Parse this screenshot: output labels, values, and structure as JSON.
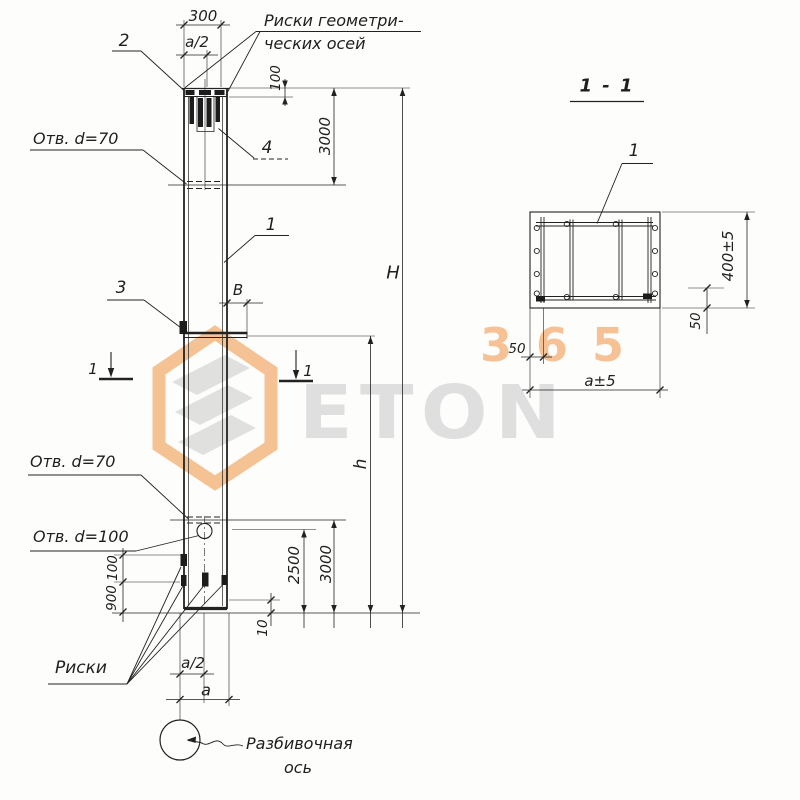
{
  "watermark": {
    "digits": "365",
    "brand": "ETON"
  },
  "elevation": {
    "dim_width_top": "300",
    "dim_half_width_top": "a/2",
    "pos_plate": "2",
    "axis_marks_note_line1": "Риски геометри-",
    "axis_marks_note_line2": "ческих осей",
    "dim_cap_offset": "100",
    "dim_top_hole": "3000",
    "hole_top": "Отв. d=70",
    "pos_anchors": "4",
    "pos_column": "1",
    "pos_embed": "3",
    "dim_console": "В",
    "dim_total": "H",
    "dim_lower": "h",
    "cut_left": "1",
    "cut_right": "1",
    "hole_mid": "Отв. d=70",
    "hole_bottom": "Отв. d=100",
    "dim_2500": "2500",
    "dim_3000_bottom": "3000",
    "dim_100_left": "100",
    "dim_900_left": "900",
    "dim_10": "10",
    "marks_label": "Риски",
    "dim_half_width_bottom": "a/2",
    "dim_width_bottom": "a",
    "axis_line1": "Разбивочная",
    "axis_line2": "ось"
  },
  "section": {
    "title": "1 - 1",
    "pos_bar": "1",
    "dim_height": "400±5",
    "dim_50_right": "50",
    "dim_50_left": "50",
    "dim_width": "a±5"
  }
}
